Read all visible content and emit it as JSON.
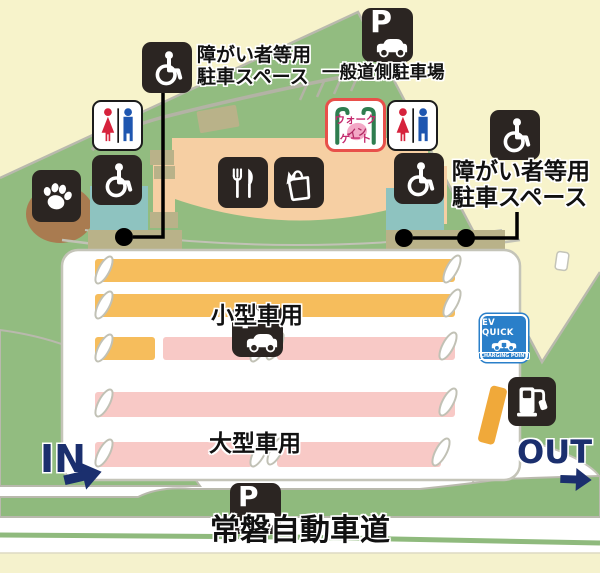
{
  "map": {
    "highway_name": "常磐自動車道",
    "in_label": "IN",
    "out_label": "OUT",
    "parking_letter": "P",
    "small_car_label": "小型車用",
    "large_car_label": "大型車用",
    "general_parking_label": "一般道側駐車場",
    "disabled_left": {
      "line1": "障がい者等用",
      "line2": "駐車スペース"
    },
    "disabled_right": {
      "line1": "障がい者等用",
      "line2": "駐車スペース"
    },
    "gate": {
      "line1": "ウォーク",
      "line2": "イン",
      "line3": "ゲート"
    },
    "ev_sign": {
      "title": "EV QUICK",
      "subtitle": "CHARGING POINT"
    },
    "icons": [
      "wheelchair-icon",
      "restroom-icon",
      "paw-icon",
      "parking-car-icon",
      "parking-truck-icon",
      "fork-knife-icon",
      "shopping-bag-icon",
      "walk-gate-icon",
      "ev-charging-icon",
      "fuel-pump-icon",
      "in-arrow-icon",
      "out-arrow-icon"
    ],
    "colors": {
      "background": "#f7f3cb",
      "hill_green": "#92bc80",
      "lot_white": "#ffffff",
      "small_car_row": "#f6bd5c",
      "large_car_row": "#f8c9c6",
      "building": "#f6cfa3",
      "restroom_block": "#8ec3c0",
      "walkway": "#b9b289",
      "dog_area": "#a97b50",
      "icon_box": "#2b2522",
      "navy": "#1b2f6e",
      "ev_blue": "#2a7fc9"
    }
  }
}
